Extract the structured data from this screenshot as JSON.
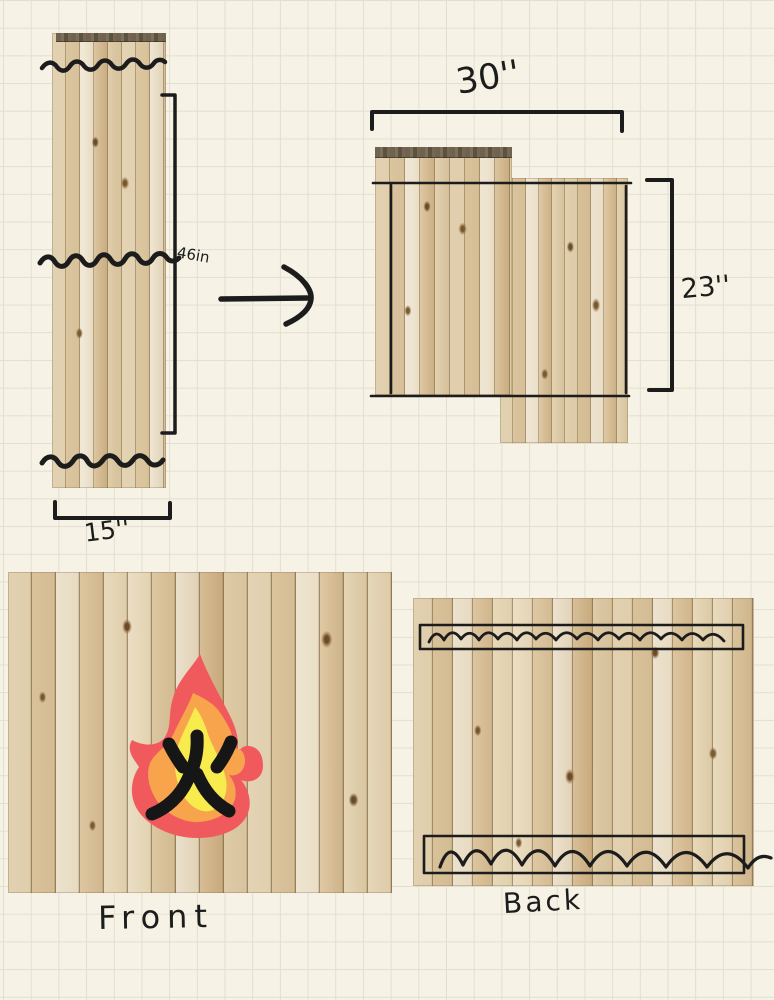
{
  "sketch_title": "pallet wood fire pit panel plan",
  "paper": {
    "background": "#f6f3e6",
    "grid_line": "#e3dfce",
    "grid_size_px": 28
  },
  "colors": {
    "ink": "#1c1c1c",
    "flame_outer": "#f15a5d",
    "flame_mid": "#f7a44c",
    "flame_core": "#f8eb4d",
    "wood_cap": "#6f6250"
  },
  "icons": {
    "fire": "fire-flame-with-kanji-icon",
    "arrow": "arrow-right-icon"
  },
  "before_panel": {
    "height_label": "46in",
    "width_label": "15''",
    "cut_lines": 3
  },
  "after_panel": {
    "width_label": "30''",
    "height_label": "23''"
  },
  "front_panel": {
    "caption": "Front"
  },
  "back_panel": {
    "caption": "Back",
    "slat_rects": 2
  }
}
